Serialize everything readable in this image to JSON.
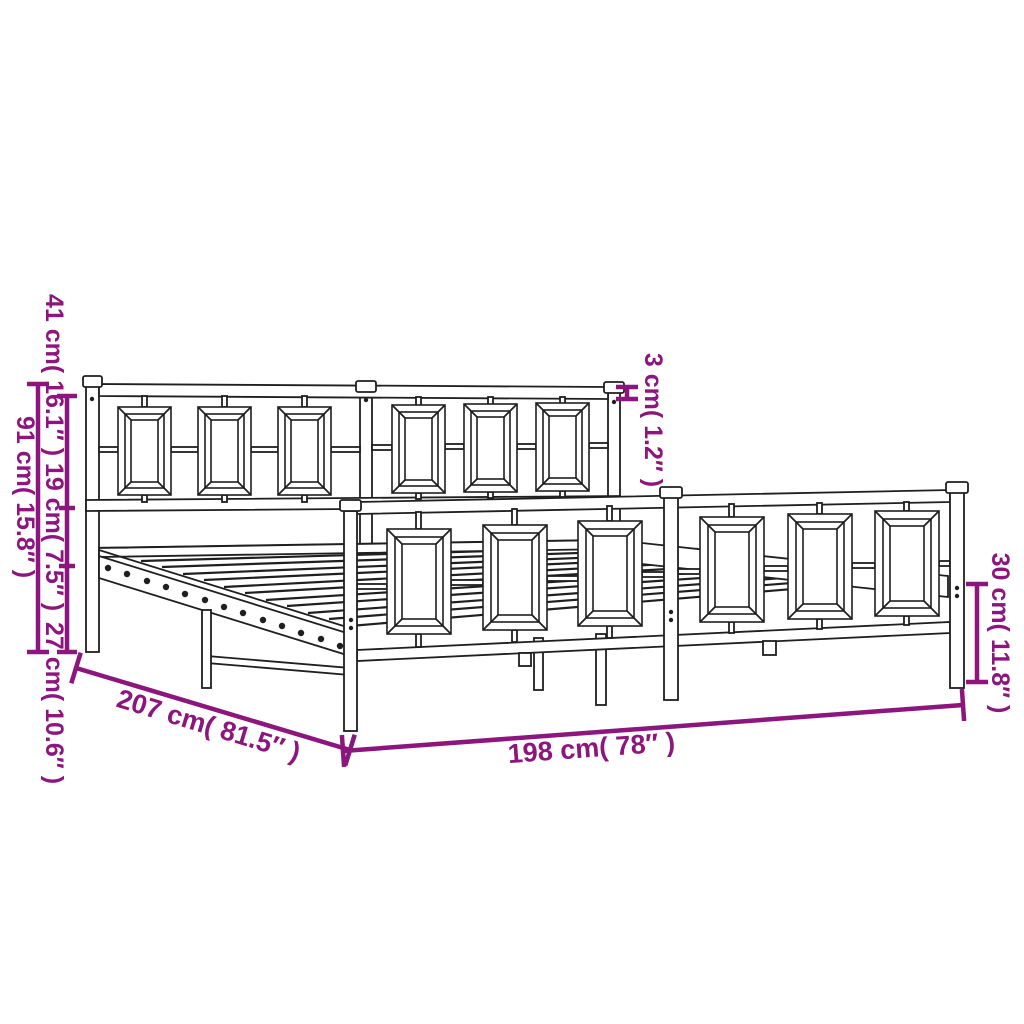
{
  "page": {
    "background_color": "#ffffff"
  },
  "diagram": {
    "subject": "metal-bed-frame-with-headboard-and-footboard-dimension-drawing",
    "line_color": "#1f1f1f",
    "accent_color": "#8C157E",
    "structure": {
      "headboard_panels": 6,
      "footboard_panels": 6,
      "slatted_base": true
    },
    "dimensions": {
      "overall_height": {
        "label": "91 cm( 15.8″ )",
        "cm": "91",
        "inches": "15.8"
      },
      "headboard_section": {
        "label": "41 cm( 16.1″ )",
        "cm": "41",
        "inches": "16.1"
      },
      "middle_section": {
        "label": "19 cm( 7.5″ )",
        "cm": "19",
        "inches": "7.5"
      },
      "leg_section": {
        "label": "27 cm( 10.6″ )",
        "cm": "27",
        "inches": "10.6"
      },
      "rail_thickness": {
        "label": "3 cm( 1.2″ )",
        "cm": "3",
        "inches": "1.2"
      },
      "footboard_height": {
        "label": "30 cm( 11.8″ )",
        "cm": "30",
        "inches": "11.8"
      },
      "frame_length": {
        "label": "207 cm( 81.5″ )",
        "cm": "207",
        "inches": "81.5"
      },
      "frame_width": {
        "label": "198 cm( 78″ )",
        "cm": "198",
        "inches": "78"
      }
    }
  }
}
